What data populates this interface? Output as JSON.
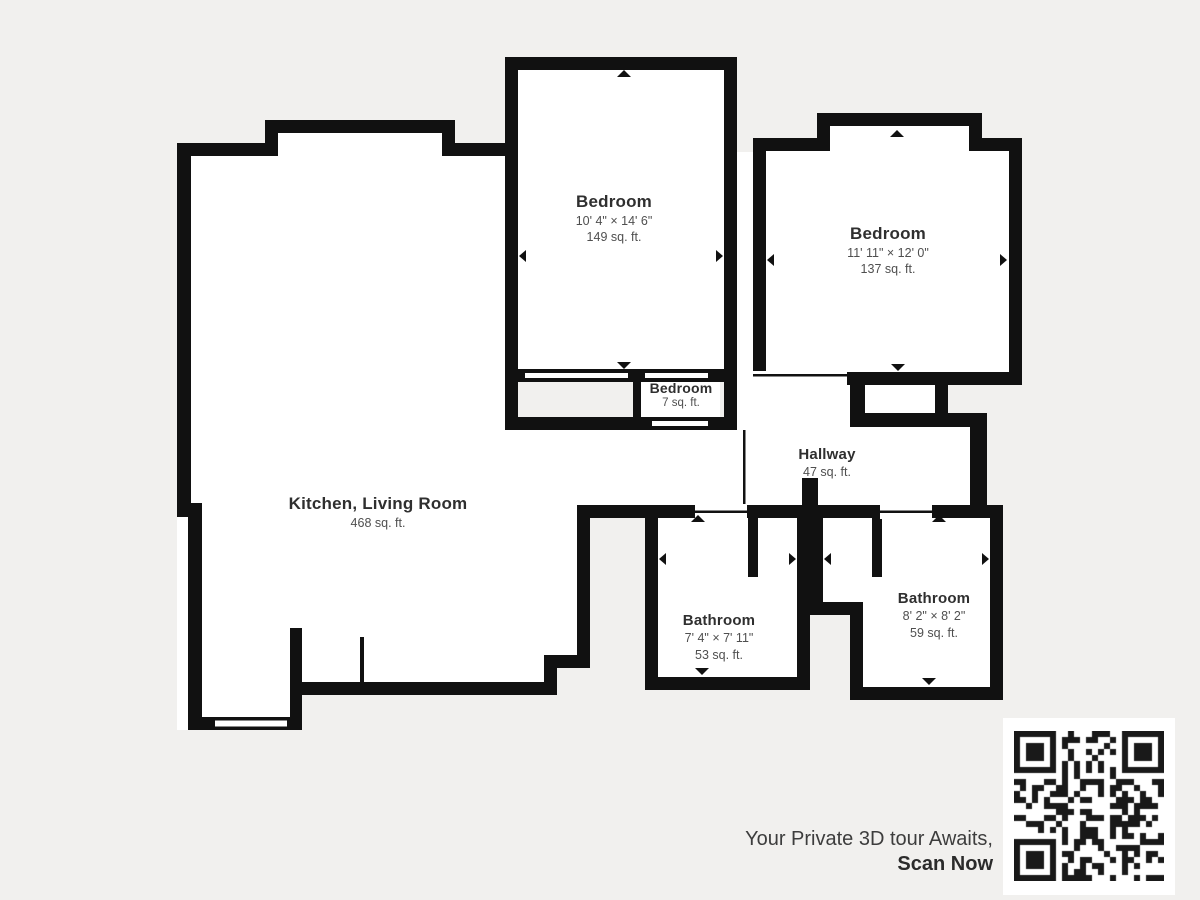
{
  "colors": {
    "background": "#f1f0ee",
    "wall": "#111111",
    "room_fill": "#ffffff",
    "label": "#2f2f2f",
    "sub_label": "#4f4f4f",
    "caption": "#3d3d3d",
    "qr_dark": "#191919"
  },
  "rooms": {
    "bedroom_top_middle": {
      "name": "Bedroom",
      "dimensions": "10' 4\" × 14' 6\"",
      "area": "149 sq. ft."
    },
    "bedroom_top_right": {
      "name": "Bedroom",
      "dimensions": "11' 11\" × 12' 0\"",
      "area": "137 sq. ft."
    },
    "bedroom_small": {
      "name": "Bedroom",
      "area": "7 sq. ft."
    },
    "hallway": {
      "name": "Hallway",
      "area": "47 sq. ft."
    },
    "kitchen_living": {
      "name": "Kitchen, Living Room",
      "area": "468 sq. ft."
    },
    "bathroom_left": {
      "name": "Bathroom",
      "dimensions": "7' 4\" × 7' 11\"",
      "area": "53 sq. ft."
    },
    "bathroom_right": {
      "name": "Bathroom",
      "dimensions": "8' 2\" × 8' 2\"",
      "area": "59 sq. ft."
    }
  },
  "cta": {
    "line1": "Your Private 3D tour Awaits,",
    "line2": "Scan Now"
  }
}
